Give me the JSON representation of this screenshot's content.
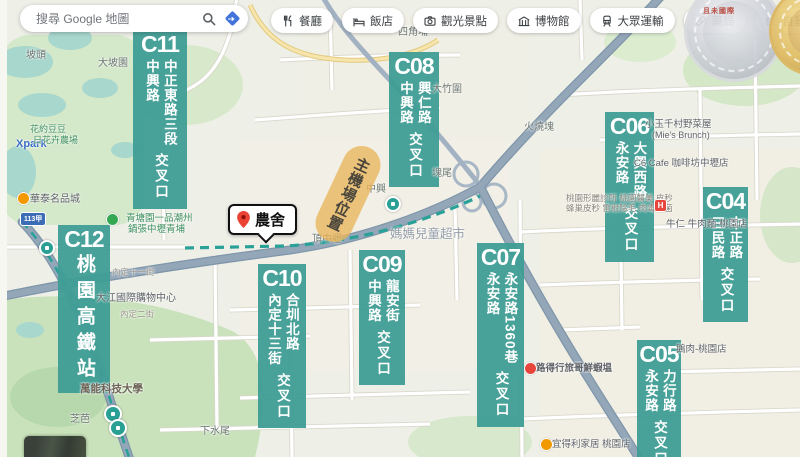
{
  "search": {
    "placeholder": "搜尋 Google 地圖"
  },
  "toolbar": {
    "chips": [
      {
        "label": "餐廳",
        "icon": "restaurant-icon"
      },
      {
        "label": "飯店",
        "icon": "hotel-icon"
      },
      {
        "label": "觀光景點",
        "icon": "camera-icon"
      },
      {
        "label": "博物館",
        "icon": "museum-icon"
      },
      {
        "label": "大眾運輸",
        "icon": "transit-icon"
      },
      {
        "label": "藥局",
        "icon": "pharmacy-icon"
      },
      {
        "label": "自動提款機",
        "icon": "atm-icon"
      }
    ]
  },
  "marker": {
    "label": "農舍"
  },
  "highlight": {
    "text": "主機場位置"
  },
  "badges": {
    "watermark_text": "且未國際"
  },
  "colors": {
    "label_teal": "#3E9D95",
    "freeway": "#93a7b9",
    "mrt_line": "#2aa198",
    "pin_red": "#ea4335",
    "directions_blue": "#4274d9"
  },
  "map": {
    "intersections": [
      {
        "id": "C11",
        "x": 133,
        "y": 30,
        "w": 52,
        "roads": [
          "中正東路三段",
          "中興路"
        ],
        "suffix": "交叉口"
      },
      {
        "id": "C08",
        "x": 389,
        "y": 52,
        "w": 48,
        "roads": [
          "興仁路",
          "中興路"
        ],
        "suffix": "交叉口"
      },
      {
        "id": "C06",
        "x": 605,
        "y": 112,
        "w": 47,
        "roads": [
          "大興西路",
          "永安路"
        ],
        "suffix": "交叉口"
      },
      {
        "id": "C04",
        "x": 703,
        "y": 187,
        "w": 43,
        "roads": [
          "中正路",
          "三民路"
        ],
        "suffix": "交叉口"
      },
      {
        "id": "C12",
        "x": 58,
        "y": 225,
        "w": 50,
        "roads": [
          "桃園高鐵站"
        ],
        "suffix": "",
        "large": true
      },
      {
        "id": "C10",
        "x": 258,
        "y": 264,
        "w": 46,
        "roads": [
          "合圳北路",
          "內定十三街"
        ],
        "suffix": "交叉口"
      },
      {
        "id": "C09",
        "x": 359,
        "y": 250,
        "w": 44,
        "roads": [
          "龍安街",
          "中興路"
        ],
        "suffix": "交叉口"
      },
      {
        "id": "C07",
        "x": 477,
        "y": 243,
        "w": 45,
        "roads": [
          "永安路1360巷",
          "永安路"
        ],
        "suffix": "交叉口"
      },
      {
        "id": "C05",
        "x": 637,
        "y": 340,
        "w": 42,
        "roads": [
          "力行路",
          "永安路"
        ],
        "suffix": "交叉口"
      }
    ],
    "place_labels": [
      {
        "t": "坡頭",
        "x": 26,
        "y": 50,
        "s": 10
      },
      {
        "t": "大坡園",
        "x": 98,
        "y": 58,
        "s": 10
      },
      {
        "t": "四角埔",
        "x": 398,
        "y": 27,
        "s": 10
      },
      {
        "t": "大竹圍",
        "x": 432,
        "y": 84,
        "s": 10
      },
      {
        "t": "火燒塊",
        "x": 524,
        "y": 122,
        "s": 10
      },
      {
        "t": "塊尾",
        "x": 432,
        "y": 168,
        "s": 10
      },
      {
        "t": "中興",
        "x": 366,
        "y": 184,
        "s": 10
      },
      {
        "t": "頂中壢",
        "x": 312,
        "y": 234,
        "s": 10
      },
      {
        "t": "下水尾",
        "x": 200,
        "y": 426,
        "s": 10
      },
      {
        "t": "芝芭",
        "x": 70,
        "y": 414,
        "s": 10
      },
      {
        "t": "萬能科技大學",
        "x": 80,
        "y": 384,
        "s": 10.5,
        "c": "#6d6456",
        "b": true
      },
      {
        "t": "大江國際購物中心",
        "x": 96,
        "y": 293,
        "s": 10,
        "c": "#5f6368"
      },
      {
        "t": "內定十一街",
        "x": 112,
        "y": 268,
        "s": 8.5,
        "c": "#9a958a"
      },
      {
        "t": "內定二街",
        "x": 120,
        "y": 310,
        "s": 8.5,
        "c": "#9a958a"
      },
      {
        "t": "Xpark",
        "x": 16,
        "y": 138,
        "s": 11,
        "c": "#3a6fc4",
        "b": true,
        "poi": true
      },
      {
        "t": "花約豆豆",
        "x": 30,
        "y": 125,
        "s": 9,
        "c": "#3d8f5f",
        "poi": true
      },
      {
        "t": "日花卉農場",
        "x": 33,
        "y": 136,
        "s": 9,
        "c": "#3d8f5f",
        "poi": true
      },
      {
        "t": "華泰名品城",
        "x": 30,
        "y": 194,
        "s": 10,
        "c": "#5f6368",
        "poi": true
      },
      {
        "t": "青塘園一品潮州",
        "x": 126,
        "y": 214,
        "s": 9.5,
        "c": "#3d8f5f",
        "poi": true
      },
      {
        "t": "鍋張中壢青埔",
        "x": 128,
        "y": 225,
        "s": 9.5,
        "c": "#3d8f5f",
        "poi": true
      },
      {
        "t": "媽媽兒童超市",
        "x": 390,
        "y": 228,
        "s": 12.5,
        "c": "#8691a0",
        "o": 0.85,
        "poi": true
      },
      {
        "t": "小玉千村野菜屋",
        "x": 645,
        "y": 120,
        "s": 9.5,
        "c": "#5f6368",
        "poi": true
      },
      {
        "t": "(Mie's Brunch)",
        "x": 652,
        "y": 131,
        "s": 9,
        "c": "#5f6368"
      },
      {
        "t": "C6 Cafe 咖啡坊中壢店",
        "x": 634,
        "y": 159,
        "s": 9.5,
        "c": "#5f6368",
        "poi": true
      },
      {
        "t": "桃園形麗診所 桃園醫美 皮秒",
        "x": 566,
        "y": 194,
        "s": 8.5,
        "c": "#8a857c"
      },
      {
        "t": "蜂巢皮秒 雷射除毛 肉毒桿菌",
        "x": 566,
        "y": 204,
        "s": 8.5,
        "c": "#8a857c"
      },
      {
        "t": "牛仁 牛肉麵-桃園店",
        "x": 666,
        "y": 220,
        "s": 9.5,
        "c": "#5f6368",
        "poi": true
      },
      {
        "t": "鵝肉-桃園店",
        "x": 676,
        "y": 345,
        "s": 9.5,
        "c": "#5f6368",
        "poi": true
      },
      {
        "t": "路得行旅哥鮮蝦塭",
        "x": 536,
        "y": 364,
        "s": 9.5,
        "c": "#5f6368",
        "b": true,
        "poi": true
      },
      {
        "t": "宜得利家居 桃園店",
        "x": 552,
        "y": 440,
        "s": 9.5,
        "c": "#5f6368",
        "poi": true
      }
    ],
    "pois": [
      {
        "type": "hospital-icon",
        "x": 654,
        "y": 199,
        "bg": "#e8453c",
        "glyph": "H",
        "square": true
      },
      {
        "type": "shopping-icon",
        "x": 17,
        "y": 192,
        "bg": "#f29900",
        "glyph": ""
      },
      {
        "type": "restaurant-poi-icon",
        "x": 524,
        "y": 362,
        "bg": "#e8453c",
        "glyph": ""
      },
      {
        "type": "store-icon",
        "x": 540,
        "y": 438,
        "bg": "#f29900",
        "glyph": ""
      },
      {
        "type": "park-icon",
        "x": 106,
        "y": 213,
        "bg": "#34a853",
        "glyph": ""
      }
    ],
    "stations": [
      {
        "x": 39,
        "y": 240,
        "r": 12
      },
      {
        "x": 104,
        "y": 405,
        "r": 14
      },
      {
        "x": 109,
        "y": 419,
        "r": 14
      },
      {
        "x": 385,
        "y": 196,
        "r": 12
      }
    ],
    "shields": [
      {
        "text": "113甲",
        "x": 20,
        "y": 212
      }
    ]
  }
}
